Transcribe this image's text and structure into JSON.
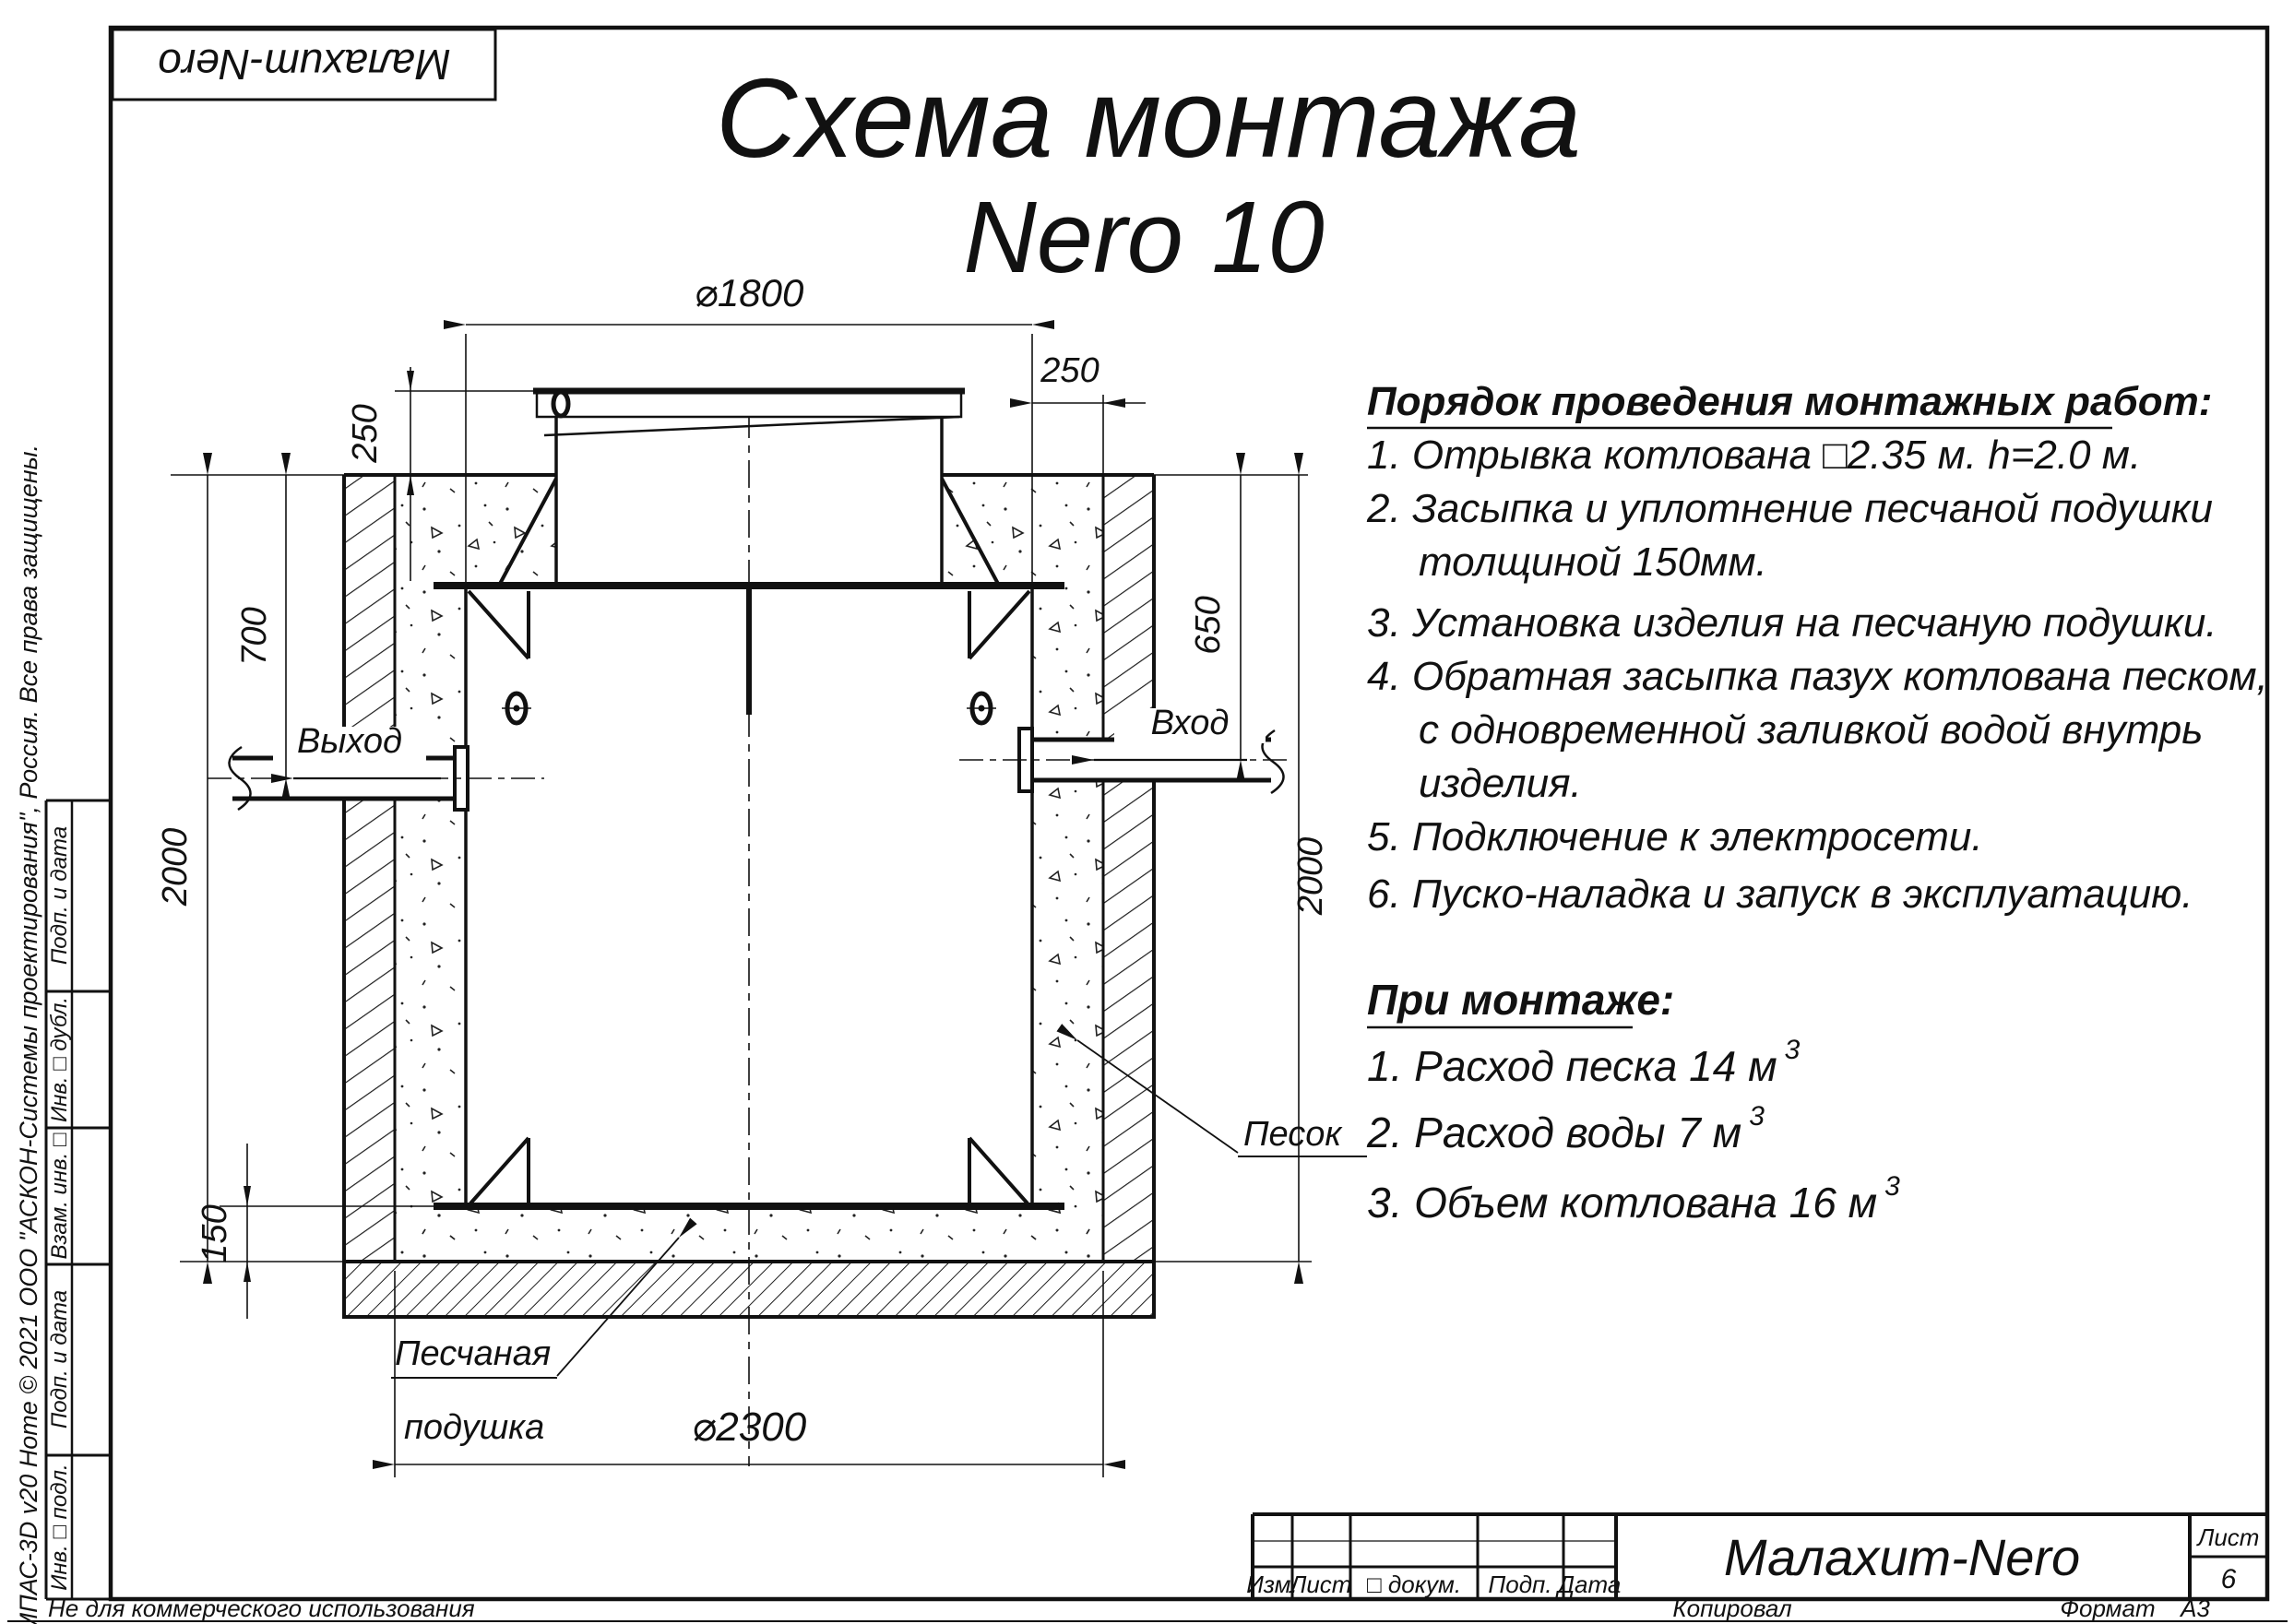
{
  "logo": "Малахит-Nero",
  "title": {
    "line1": "Схема монтажа",
    "line2": "Nero 10"
  },
  "instructions": {
    "header": "Порядок проведения монтажных работ:",
    "lines": [
      "1. Отрывка котлована □2.35 м. h=2.0 м.",
      "2. Засыпка и уплотнение песчаной подушки",
      "толщиной 150мм.",
      "3. Установка изделия на песчаную подушки.",
      "4. Обратная засыпка пазух котлована песком,",
      "с одновременной заливкой водой внутрь",
      "изделия.",
      "5. Подключение к электросети.",
      "6. Пуско-наладка и запуск в эксплуатацию."
    ]
  },
  "montage": {
    "header": "При монтаже:",
    "items": [
      {
        "text": "1. Расход песка 14 м",
        "sup": "3"
      },
      {
        "text": "2. Расход воды 7 м",
        "sup": "3"
      },
      {
        "text": "3. Объем котлована 16 м",
        "sup": "3"
      }
    ]
  },
  "drawing": {
    "dims": {
      "top_diameter": "⌀1800",
      "lid_height": "250",
      "side_gap": "250",
      "outlet_depth": "700",
      "depth_left": "2000",
      "inlet_depth": "650",
      "depth_right": "2000",
      "cushion_thickness": "150",
      "pit_diameter": "⌀2300"
    },
    "labels": {
      "outlet": "Выход",
      "inlet": "Вход",
      "sand": "Песок",
      "cushion1": "Песчаная",
      "cushion2": "подушка"
    }
  },
  "titleblock": {
    "col_izm": "Изм.",
    "col_list": "Лист",
    "col_doc": "□ докум.",
    "col_sign": "Подп.",
    "col_date": "Дата",
    "product": "Малахит-Nero",
    "sheet_label": "Лист",
    "sheet_number": "6"
  },
  "sidebar": {
    "cells": [
      "Подп. и дата",
      "Инв. □ дубл.",
      "Взам. инв. □",
      "Подп. и дата",
      "Инв. □ подл."
    ]
  },
  "footer": {
    "not_commercial": "Не для коммерческого использования",
    "copied": "Копировал",
    "format_label": "Формат",
    "format_value": "А3"
  },
  "copyright": "КОМПАС-3D v20 Home © 2021 ООО \"АСКОН-Системы проектирования\", Россия. Все права защищены."
}
